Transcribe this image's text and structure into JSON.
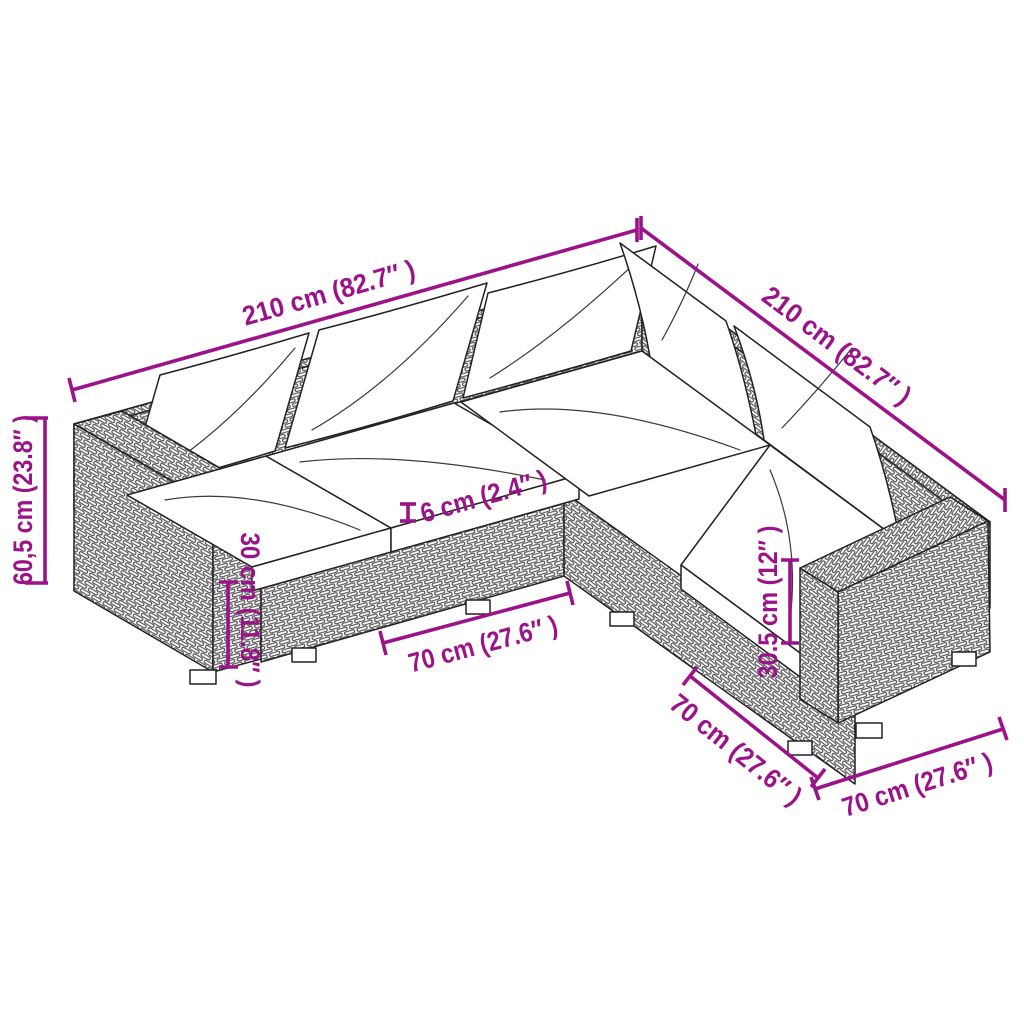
{
  "colors": {
    "accent": "#9C1289",
    "line_art": "#222222",
    "background": "#FFFFFF"
  },
  "dimensions": {
    "top_left_length": "210 cm (82.7″ )",
    "top_right_length": "210 cm (82.7″ )",
    "total_height": "60,5 cm (23.8″ )",
    "left_seat_height": "30 cm (11.8″ )",
    "seat_rim_height": "6 cm (2.4″ )",
    "front_module_width": "70 cm (27.6″ )",
    "right_seat_height": "30.5 cm (12″ )",
    "right_module_depth": "70 cm (27.6″ )",
    "right_module_width": "70 cm (27.6″ )"
  }
}
